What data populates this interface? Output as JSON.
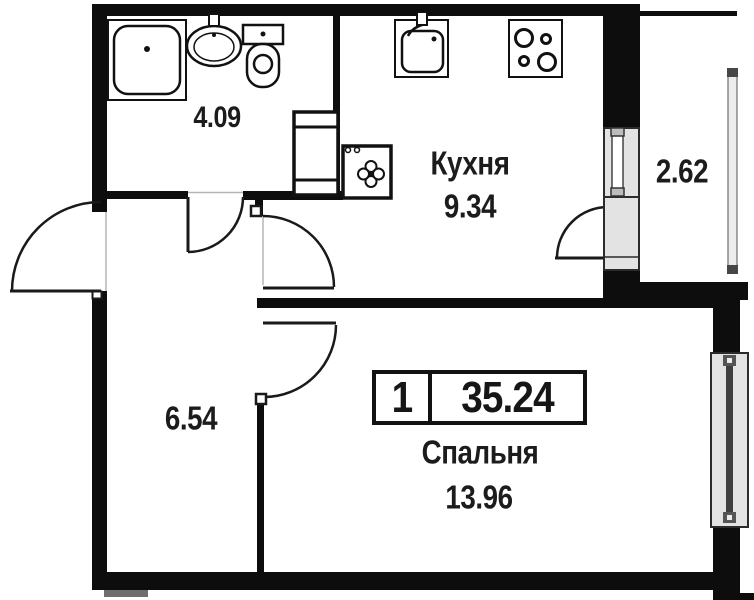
{
  "plan": {
    "kind": "apartment-floorplan",
    "badge": {
      "room_count": "1",
      "total_area": "35.24"
    },
    "rooms": [
      {
        "key": "bathroom",
        "name": "",
        "area": "4.09"
      },
      {
        "key": "kitchen",
        "name": "Кухня",
        "area": "9.34"
      },
      {
        "key": "balcony",
        "name": "",
        "area": "2.62"
      },
      {
        "key": "hallway",
        "name": "",
        "area": "6.54"
      },
      {
        "key": "bedroom",
        "name": "Спальня",
        "area": "13.96"
      }
    ],
    "fixture_icons": [
      "shower-tray-icon",
      "washbasin-icon",
      "toilet-icon",
      "vent-shaft-icon",
      "washing-machine-icon",
      "kitchen-sink-icon",
      "stove-icon"
    ],
    "colors": {
      "wall": "#0d0d0d",
      "floor": "#ffffff",
      "window_fill": "#e3e3e3",
      "window_frame": "#2b2b2b",
      "glazing_cap": "#474747",
      "text": "#1c1c1c"
    }
  }
}
